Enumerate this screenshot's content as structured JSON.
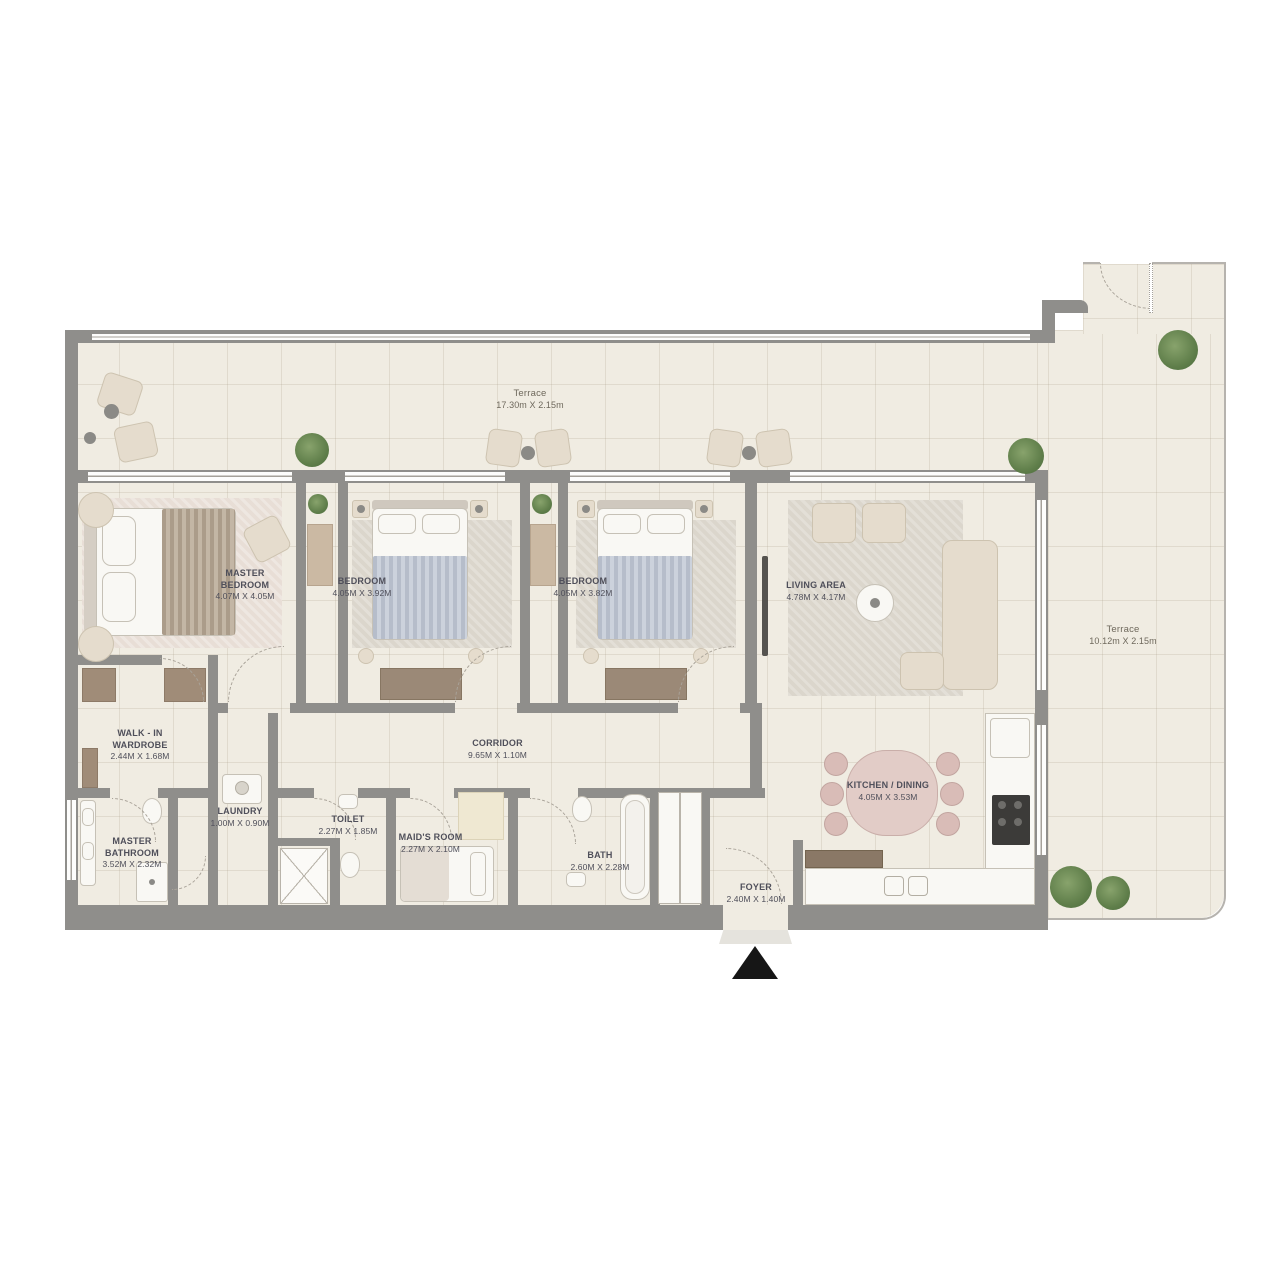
{
  "rooms": [
    {
      "id": "terrace-top",
      "name": "Terrace",
      "dims": "17.30m X 2.15m"
    },
    {
      "id": "master-bedroom",
      "name": "MASTER BEDROOM",
      "dims": "4.07m X 4.05m"
    },
    {
      "id": "bedroom-1",
      "name": "BEDROOM",
      "dims": "4.05m X 3.92m"
    },
    {
      "id": "bedroom-2",
      "name": "BEDROOM",
      "dims": "4.05m X 3.82m"
    },
    {
      "id": "living-area",
      "name": "LIVING AREA",
      "dims": "4.78m X 4.17m"
    },
    {
      "id": "terrace-right",
      "name": "Terrace",
      "dims": "10.12m X 2.15m"
    },
    {
      "id": "walk-in-wardrobe",
      "name": "WALK - IN WARDROBE",
      "dims": "2.44m X 1.68m"
    },
    {
      "id": "corridor",
      "name": "CORRIDOR",
      "dims": "9.65m X 1.10m"
    },
    {
      "id": "master-bathroom",
      "name": "MASTER BATHROOM",
      "dims": "3.52m X 2.32m"
    },
    {
      "id": "laundry",
      "name": "LAUNDRY",
      "dims": "1.00m X 0.90m"
    },
    {
      "id": "toilet",
      "name": "TOILET",
      "dims": "2.27m X 1.85m"
    },
    {
      "id": "maids-room",
      "name": "MAID'S ROOM",
      "dims": "2.27m X 2.10m"
    },
    {
      "id": "bath",
      "name": "BATH",
      "dims": "2.60m X 2.28m"
    },
    {
      "id": "kitchen-dining",
      "name": "KITCHEN / DINING",
      "dims": "4.05m X 3.53m"
    },
    {
      "id": "foyer",
      "name": "FOYER",
      "dims": "2.40m X 1.40m"
    }
  ],
  "markers": {
    "entrance_arrow": "entry-direction-triangle"
  },
  "colors": {
    "wall": "#8f8e8b",
    "floor": "#f0ece2",
    "rail": "#b6b3ae",
    "wood": "#a08c78",
    "plant": "#6e8c5a",
    "dining": "#dfc9c4",
    "label_text": "#4f4f5a",
    "entrance": "#161616"
  }
}
